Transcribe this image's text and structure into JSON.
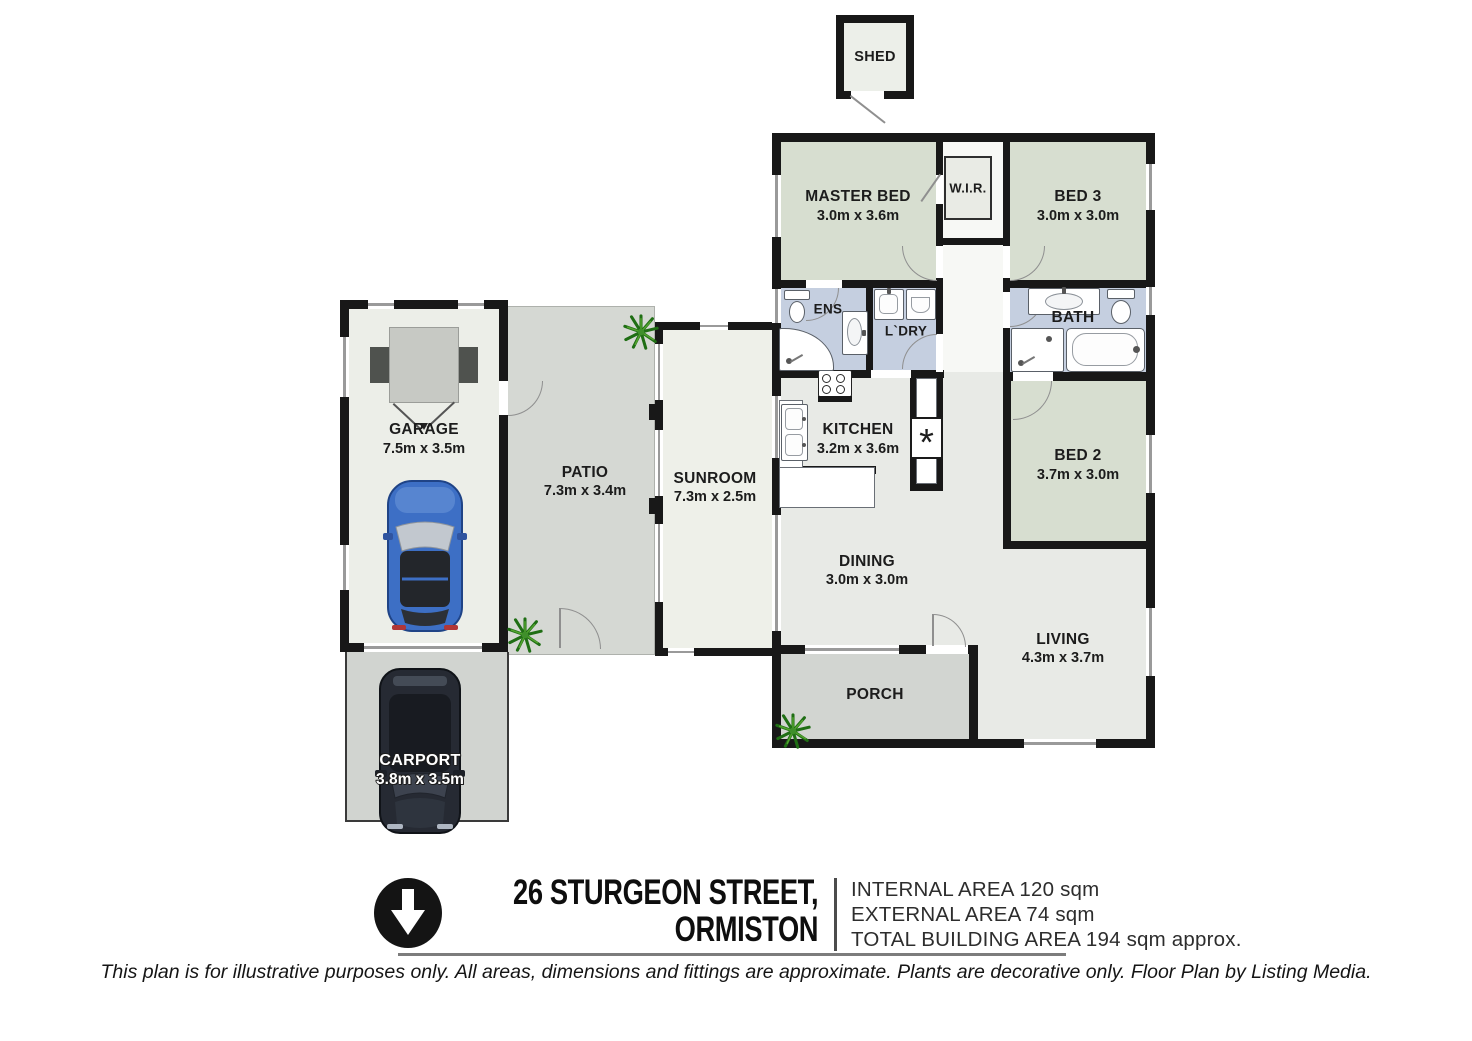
{
  "meta": {
    "type": "floor-plan"
  },
  "colors": {
    "wall": "#181818",
    "bedroom_green": "#d7ded0",
    "wet_area_blue": "#c5cfe0",
    "interior_floor": "#e8eae6",
    "outdoor_grey": "#d5d8d3",
    "sunroom_floor": "#eef0e9",
    "plant_green": "#2f7d1e"
  },
  "rooms": {
    "shed": {
      "name": "SHED"
    },
    "master_bed": {
      "name": "MASTER BED",
      "dims": "3.0m x 3.6m"
    },
    "wir": {
      "name": "W.I.R."
    },
    "bed3": {
      "name": "BED 3",
      "dims": "3.0m x 3.0m"
    },
    "ens": {
      "name": "ENS"
    },
    "laundry": {
      "name": "L`DRY"
    },
    "bath": {
      "name": "BATH"
    },
    "kitchen": {
      "name": "KITCHEN",
      "dims": "3.2m x 3.6m"
    },
    "bed2": {
      "name": "BED 2",
      "dims": "3.7m x 3.0m"
    },
    "dining": {
      "name": "DINING",
      "dims": "3.0m x 3.0m"
    },
    "living": {
      "name": "LIVING",
      "dims": "4.3m x 3.7m"
    },
    "sunroom": {
      "name": "SUNROOM",
      "dims": "7.3m x 2.5m"
    },
    "patio": {
      "name": "PATIO",
      "dims": "7.3m x 3.4m"
    },
    "garage": {
      "name": "GARAGE",
      "dims": "7.5m x 3.5m"
    },
    "carport": {
      "name": "CARPORT",
      "dims": "3.8m x 3.5m"
    },
    "porch": {
      "name": "PORCH"
    }
  },
  "symbols": {
    "pantry": "*"
  },
  "footer": {
    "address_line1": "26 STURGEON STREET,",
    "address_line2": "ORMISTON",
    "areas": [
      "INTERNAL AREA 120 sqm",
      "EXTERNAL AREA 74 sqm",
      "TOTAL BUILDING AREA 194 sqm approx."
    ],
    "disclaimer": "This plan is for illustrative purposes only. All areas, dimensions and fittings are approximate. Plants are decorative only. Floor Plan by Listing Media."
  }
}
